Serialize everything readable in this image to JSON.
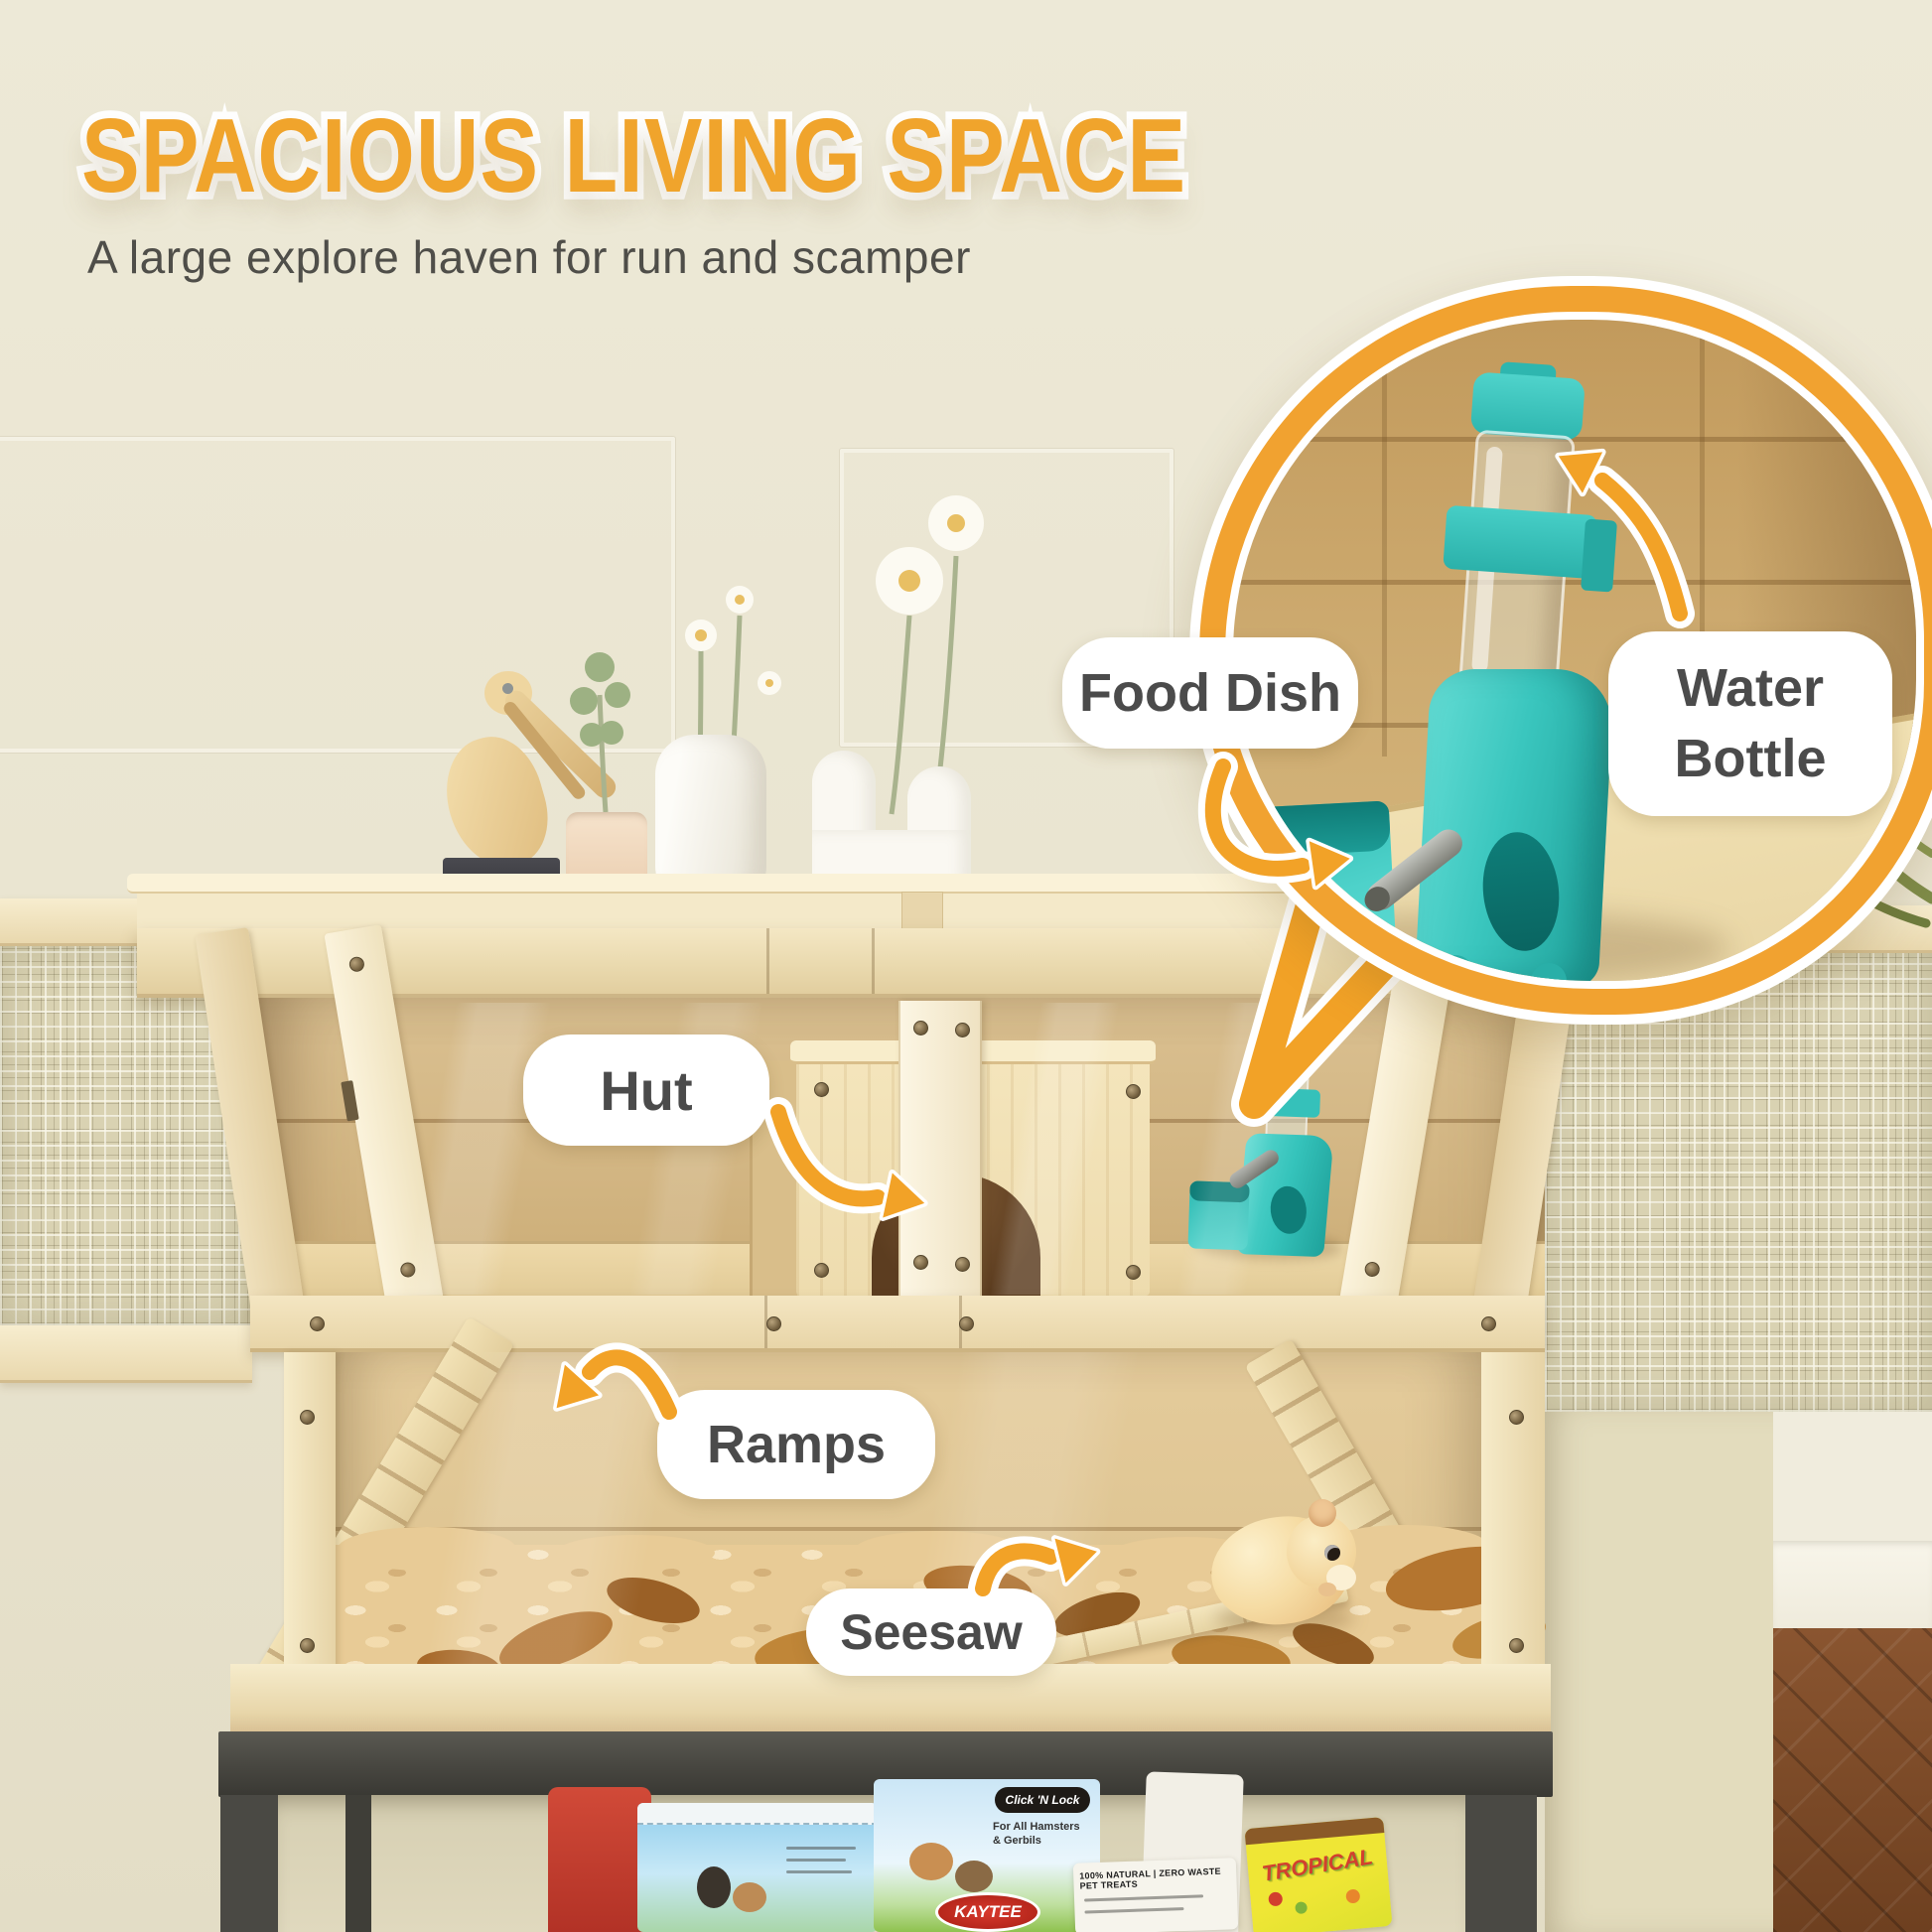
{
  "header": {
    "title": "SPACIOUS LIVING SPACE",
    "subtitle": "A large explore haven for run and scamper"
  },
  "callouts": {
    "food_dish": "Food Dish",
    "water_bottle": "Water Bottle",
    "hut": "Hut",
    "ramps": "Ramps",
    "seesaw": "Seesaw"
  },
  "packages": {
    "click_n_lock": "Click 'N Lock",
    "for_all_line1": "For All Hamsters",
    "for_all_line2": "& Gerbils",
    "kaytee": "KAYTEE",
    "natural_treats": "100% NATURAL | ZERO WASTE PET TREATS",
    "tropical": "TROPICAL"
  },
  "colors": {
    "accent_orange": "#F2A227",
    "title_orange": "#F0A42C",
    "label_text": "#4B4B4B",
    "teal": "#3CC8C0",
    "wood_light": "#F3E7C6",
    "wood_mid": "#D6BC8B",
    "wall_beige": "#EAE6D4",
    "stand_gray": "#4B4A46"
  }
}
